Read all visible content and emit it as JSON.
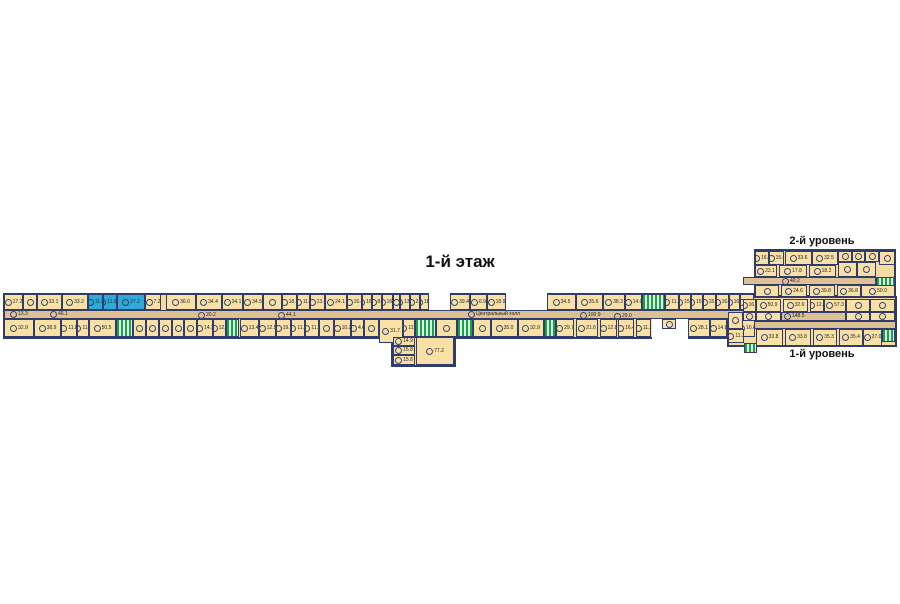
{
  "title": "1-й этаж",
  "labels": {
    "level2": "2-й уровень",
    "level1": "1-й уровень"
  },
  "colors": {
    "background": "#ffffff",
    "room_fill": "#f9e0a5",
    "corridor_fill": "#dec193",
    "wall": "#303c6e",
    "highlight_fill": "#2fa9d8",
    "stairs_green": "#18a24c"
  },
  "floor_plan": {
    "outlines": [
      {
        "x": 3,
        "y": 293,
        "w": 753,
        "h": 46
      },
      {
        "x": 391,
        "y": 336,
        "w": 65,
        "h": 31
      },
      {
        "x": 754,
        "y": 249,
        "w": 142,
        "h": 48
      },
      {
        "x": 727,
        "y": 296,
        "w": 170,
        "h": 51
      }
    ],
    "voids": [
      {
        "x": 429,
        "y": 293,
        "w": 21,
        "h": 17
      },
      {
        "x": 506,
        "y": 293,
        "w": 41,
        "h": 17
      },
      {
        "x": 652,
        "y": 319,
        "w": 36,
        "h": 21
      }
    ],
    "corridors": [
      {
        "x": 4,
        "y": 310,
        "w": 752,
        "h": 9
      },
      {
        "x": 743,
        "y": 277,
        "w": 133,
        "h": 8
      },
      {
        "x": 728,
        "y": 321,
        "w": 168,
        "h": 8
      },
      {
        "x": 781,
        "y": 312,
        "w": 65,
        "h": 9
      }
    ],
    "rooms": [
      {
        "x": 4,
        "y": 294,
        "w": 19,
        "h": 16,
        "a": "17.2"
      },
      {
        "x": 23,
        "y": 294,
        "w": 14,
        "h": 16,
        "a": ""
      },
      {
        "x": 37,
        "y": 294,
        "w": 25,
        "h": 16,
        "a": "33.1"
      },
      {
        "x": 62,
        "y": 294,
        "w": 26,
        "h": 16,
        "a": "33.2"
      },
      {
        "x": 88,
        "y": 294,
        "w": 15,
        "h": 16,
        "a": "11.5",
        "t": "hl"
      },
      {
        "x": 103,
        "y": 294,
        "w": 14,
        "h": 16,
        "a": "11.8/1",
        "t": "hl"
      },
      {
        "x": 117,
        "y": 294,
        "w": 28,
        "h": 16,
        "a": "37.2",
        "t": "hl"
      },
      {
        "x": 145,
        "y": 294,
        "w": 16,
        "h": 16,
        "a": "7.2"
      },
      {
        "x": 166,
        "y": 294,
        "w": 30,
        "h": 16,
        "a": "36.0"
      },
      {
        "x": 196,
        "y": 294,
        "w": 26,
        "h": 16,
        "a": "34.4"
      },
      {
        "x": 222,
        "y": 294,
        "w": 21,
        "h": 16,
        "a": "34.1"
      },
      {
        "x": 243,
        "y": 294,
        "w": 20,
        "h": 16,
        "a": "34.5"
      },
      {
        "x": 263,
        "y": 294,
        "w": 19,
        "h": 16,
        "a": ""
      },
      {
        "x": 282,
        "y": 294,
        "w": 15,
        "h": 16,
        "a": "18.3"
      },
      {
        "x": 297,
        "y": 294,
        "w": 13,
        "h": 16,
        "a": "11.9"
      },
      {
        "x": 310,
        "y": 294,
        "w": 15,
        "h": 16,
        "a": "13.5"
      },
      {
        "x": 325,
        "y": 294,
        "w": 22,
        "h": 16,
        "a": "24.1"
      },
      {
        "x": 347,
        "y": 294,
        "w": 15,
        "h": 16,
        "a": "16.4"
      },
      {
        "x": 362,
        "y": 294,
        "w": 10,
        "h": 16,
        "a": "16.4"
      },
      {
        "x": 372,
        "y": 294,
        "w": 10,
        "h": 16,
        "a": "8.5"
      },
      {
        "x": 382,
        "y": 294,
        "w": 11,
        "h": 16,
        "a": "16.4"
      },
      {
        "x": 393,
        "y": 294,
        "w": 7,
        "h": 16,
        "a": ""
      },
      {
        "x": 400,
        "y": 294,
        "w": 10,
        "h": 16,
        "a": "13.8"
      },
      {
        "x": 410,
        "y": 294,
        "w": 10,
        "h": 16,
        "a": "2.5"
      },
      {
        "x": 420,
        "y": 294,
        "w": 9,
        "h": 16,
        "a": "11.7"
      },
      {
        "x": 450,
        "y": 294,
        "w": 20,
        "h": 16,
        "a": "39.4"
      },
      {
        "x": 470,
        "y": 294,
        "w": 17,
        "h": 16,
        "a": "6.9"
      },
      {
        "x": 487,
        "y": 294,
        "w": 19,
        "h": 16,
        "a": "18.9"
      },
      {
        "x": 547,
        "y": 294,
        "w": 29,
        "h": 16,
        "a": "34.5"
      },
      {
        "x": 576,
        "y": 294,
        "w": 27,
        "h": 16,
        "a": "35.6"
      },
      {
        "x": 603,
        "y": 294,
        "w": 22,
        "h": 16,
        "a": "38.3"
      },
      {
        "x": 625,
        "y": 294,
        "w": 17,
        "h": 16,
        "a": "14.0"
      },
      {
        "x": 642,
        "y": 294,
        "w": 23,
        "h": 16,
        "a": "",
        "t": "stair"
      },
      {
        "x": 665,
        "y": 294,
        "w": 14,
        "h": 16,
        "a": "11.2"
      },
      {
        "x": 679,
        "y": 294,
        "w": 12,
        "h": 16,
        "a": "15.5"
      },
      {
        "x": 691,
        "y": 294,
        "w": 12,
        "h": 16,
        "a": "15.6"
      },
      {
        "x": 703,
        "y": 294,
        "w": 13,
        "h": 16,
        "a": "15.1"
      },
      {
        "x": 716,
        "y": 294,
        "w": 13,
        "h": 16,
        "a": "16.1"
      },
      {
        "x": 729,
        "y": 294,
        "w": 11,
        "h": 16,
        "a": "16.3"
      },
      {
        "x": 740,
        "y": 294,
        "w": 14,
        "h": 16,
        "a": "16.4"
      },
      {
        "x": 4,
        "y": 319,
        "w": 30,
        "h": 18,
        "a": "32.9"
      },
      {
        "x": 34,
        "y": 319,
        "w": 27,
        "h": 18,
        "a": "38.9"
      },
      {
        "x": 61,
        "y": 319,
        "w": 16,
        "h": 18,
        "a": "11.8"
      },
      {
        "x": 77,
        "y": 319,
        "w": 12,
        "h": 18,
        "a": "11.2"
      },
      {
        "x": 89,
        "y": 319,
        "w": 27,
        "h": 18,
        "a": "50.5"
      },
      {
        "x": 116,
        "y": 319,
        "w": 17,
        "h": 18,
        "a": "",
        "t": "stair"
      },
      {
        "x": 133,
        "y": 319,
        "w": 13,
        "h": 18,
        "a": ""
      },
      {
        "x": 146,
        "y": 319,
        "w": 13,
        "h": 18,
        "a": ""
      },
      {
        "x": 159,
        "y": 319,
        "w": 13,
        "h": 18,
        "a": ""
      },
      {
        "x": 172,
        "y": 319,
        "w": 12,
        "h": 18,
        "a": ""
      },
      {
        "x": 184,
        "y": 319,
        "w": 13,
        "h": 18,
        "a": ""
      },
      {
        "x": 197,
        "y": 319,
        "w": 16,
        "h": 18,
        "a": "14.3"
      },
      {
        "x": 213,
        "y": 319,
        "w": 13,
        "h": 18,
        "a": "12.5"
      },
      {
        "x": 226,
        "y": 319,
        "w": 13,
        "h": 18,
        "a": "",
        "t": "stair"
      },
      {
        "x": 240,
        "y": 319,
        "w": 19,
        "h": 18,
        "a": "13.4"
      },
      {
        "x": 259,
        "y": 319,
        "w": 17,
        "h": 18,
        "a": "12.5"
      },
      {
        "x": 276,
        "y": 319,
        "w": 15,
        "h": 18,
        "a": "19.1"
      },
      {
        "x": 291,
        "y": 319,
        "w": 14,
        "h": 18,
        "a": "11.2"
      },
      {
        "x": 305,
        "y": 319,
        "w": 14,
        "h": 18,
        "a": "11.7"
      },
      {
        "x": 319,
        "y": 319,
        "w": 15,
        "h": 18,
        "a": ""
      },
      {
        "x": 334,
        "y": 319,
        "w": 17,
        "h": 18,
        "a": "10.2"
      },
      {
        "x": 351,
        "y": 319,
        "w": 13,
        "h": 18,
        "a": "4.6"
      },
      {
        "x": 364,
        "y": 319,
        "w": 15,
        "h": 18,
        "a": ""
      },
      {
        "x": 379,
        "y": 319,
        "w": 24,
        "h": 24,
        "a": "31.7"
      },
      {
        "x": 403,
        "y": 319,
        "w": 12,
        "h": 18,
        "a": "11.5"
      },
      {
        "x": 415,
        "y": 319,
        "w": 21,
        "h": 18,
        "a": "",
        "t": "stair"
      },
      {
        "x": 436,
        "y": 319,
        "w": 21,
        "h": 18,
        "a": ""
      },
      {
        "x": 457,
        "y": 319,
        "w": 16,
        "h": 18,
        "a": "",
        "t": "stair"
      },
      {
        "x": 473,
        "y": 319,
        "w": 18,
        "h": 18,
        "a": ""
      },
      {
        "x": 491,
        "y": 319,
        "w": 27,
        "h": 18,
        "a": "35.0"
      },
      {
        "x": 518,
        "y": 319,
        "w": 26,
        "h": 18,
        "a": "32.9"
      },
      {
        "x": 544,
        "y": 319,
        "w": 12,
        "h": 18,
        "a": "",
        "t": "stair"
      },
      {
        "x": 556,
        "y": 319,
        "w": 18,
        "h": 18,
        "a": "29.7"
      },
      {
        "x": 576,
        "y": 319,
        "w": 22,
        "h": 18,
        "a": "21.6"
      },
      {
        "x": 600,
        "y": 319,
        "w": 17,
        "h": 18,
        "a": "12.8"
      },
      {
        "x": 618,
        "y": 319,
        "w": 16,
        "h": 18,
        "a": "16.4"
      },
      {
        "x": 636,
        "y": 319,
        "w": 15,
        "h": 18,
        "a": "11.2"
      },
      {
        "x": 662,
        "y": 319,
        "w": 14,
        "h": 10,
        "a": ""
      },
      {
        "x": 688,
        "y": 319,
        "w": 22,
        "h": 18,
        "a": "28.1"
      },
      {
        "x": 710,
        "y": 319,
        "w": 17,
        "h": 18,
        "a": "14.8"
      },
      {
        "x": 727,
        "y": 319,
        "w": 12,
        "h": 18,
        "a": "",
        "t": "stair"
      },
      {
        "x": 739,
        "y": 319,
        "w": 16,
        "h": 18,
        "a": "16.6"
      },
      {
        "x": 393,
        "y": 337,
        "w": 22,
        "h": 9,
        "a": "14.9"
      },
      {
        "x": 393,
        "y": 346,
        "w": 22,
        "h": 9,
        "a": "15.8"
      },
      {
        "x": 393,
        "y": 355,
        "w": 22,
        "h": 10,
        "a": "15.8"
      },
      {
        "x": 416,
        "y": 337,
        "w": 38,
        "h": 28,
        "a": "77.2"
      },
      {
        "x": 755,
        "y": 251,
        "w": 14,
        "h": 14,
        "a": "16.1"
      },
      {
        "x": 769,
        "y": 251,
        "w": 15,
        "h": 14,
        "a": "15.0"
      },
      {
        "x": 785,
        "y": 251,
        "w": 27,
        "h": 14,
        "a": "33.6"
      },
      {
        "x": 812,
        "y": 251,
        "w": 26,
        "h": 14,
        "a": "32.5"
      },
      {
        "x": 838,
        "y": 251,
        "w": 14,
        "h": 11,
        "a": ""
      },
      {
        "x": 852,
        "y": 251,
        "w": 13,
        "h": 11,
        "a": ""
      },
      {
        "x": 865,
        "y": 251,
        "w": 14,
        "h": 11,
        "a": ""
      },
      {
        "x": 879,
        "y": 251,
        "w": 16,
        "h": 14,
        "a": ""
      },
      {
        "x": 755,
        "y": 265,
        "w": 22,
        "h": 12,
        "a": "22.1"
      },
      {
        "x": 779,
        "y": 265,
        "w": 28,
        "h": 12,
        "a": "17.8"
      },
      {
        "x": 809,
        "y": 265,
        "w": 27,
        "h": 12,
        "a": "18.2"
      },
      {
        "x": 838,
        "y": 262,
        "w": 19,
        "h": 15,
        "a": ""
      },
      {
        "x": 857,
        "y": 262,
        "w": 19,
        "h": 15,
        "a": ""
      },
      {
        "x": 876,
        "y": 277,
        "w": 19,
        "h": 10,
        "a": "",
        "t": "stair"
      },
      {
        "x": 755,
        "y": 285,
        "w": 24,
        "h": 12,
        "a": ""
      },
      {
        "x": 781,
        "y": 285,
        "w": 26,
        "h": 12,
        "a": "24.6"
      },
      {
        "x": 809,
        "y": 285,
        "w": 26,
        "h": 12,
        "a": "39.8"
      },
      {
        "x": 837,
        "y": 285,
        "w": 24,
        "h": 12,
        "a": "36.8"
      },
      {
        "x": 861,
        "y": 285,
        "w": 34,
        "h": 12,
        "a": "50.0"
      },
      {
        "x": 743,
        "y": 299,
        "w": 13,
        "h": 13,
        "a": "16.4"
      },
      {
        "x": 756,
        "y": 299,
        "w": 25,
        "h": 13,
        "a": "50.9"
      },
      {
        "x": 783,
        "y": 299,
        "w": 25,
        "h": 13,
        "a": "32.6"
      },
      {
        "x": 810,
        "y": 299,
        "w": 14,
        "h": 13,
        "a": "12.2"
      },
      {
        "x": 824,
        "y": 299,
        "w": 22,
        "h": 13,
        "a": "57.3"
      },
      {
        "x": 846,
        "y": 299,
        "w": 24,
        "h": 13,
        "a": ""
      },
      {
        "x": 870,
        "y": 299,
        "w": 25,
        "h": 13,
        "a": ""
      },
      {
        "x": 743,
        "y": 312,
        "w": 13,
        "h": 9,
        "a": ""
      },
      {
        "x": 756,
        "y": 312,
        "w": 25,
        "h": 9,
        "a": ""
      },
      {
        "x": 846,
        "y": 312,
        "w": 24,
        "h": 9,
        "a": ""
      },
      {
        "x": 870,
        "y": 312,
        "w": 25,
        "h": 9,
        "a": ""
      },
      {
        "x": 728,
        "y": 312,
        "w": 15,
        "h": 17,
        "a": ""
      },
      {
        "x": 728,
        "y": 329,
        "w": 16,
        "h": 14,
        "a": "11.3"
      },
      {
        "x": 744,
        "y": 343,
        "w": 13,
        "h": 10,
        "a": "",
        "t": "stair"
      },
      {
        "x": 756,
        "y": 329,
        "w": 27,
        "h": 17,
        "a": "33.8"
      },
      {
        "x": 785,
        "y": 329,
        "w": 26,
        "h": 17,
        "a": "33.8"
      },
      {
        "x": 813,
        "y": 329,
        "w": 24,
        "h": 17,
        "a": "35.3"
      },
      {
        "x": 839,
        "y": 329,
        "w": 24,
        "h": 17,
        "a": "35.4"
      },
      {
        "x": 863,
        "y": 329,
        "w": 19,
        "h": 17,
        "a": "27.0"
      },
      {
        "x": 882,
        "y": 329,
        "w": 13,
        "h": 13,
        "a": "",
        "t": "stair"
      }
    ],
    "corridor_labels": [
      {
        "x": 10,
        "y": 311,
        "text": "13.3"
      },
      {
        "x": 50,
        "y": 311,
        "text": "46.1"
      },
      {
        "x": 198,
        "y": 312,
        "text": "20.2"
      },
      {
        "x": 278,
        "y": 312,
        "text": "44.1"
      },
      {
        "x": 468,
        "y": 311,
        "text": "Центральный холл"
      },
      {
        "x": 580,
        "y": 312,
        "text": "100.9"
      },
      {
        "x": 614,
        "y": 313,
        "text": "29.0"
      },
      {
        "x": 782,
        "y": 278,
        "text": "40.2"
      },
      {
        "x": 784,
        "y": 313,
        "text": "148.5"
      }
    ]
  }
}
